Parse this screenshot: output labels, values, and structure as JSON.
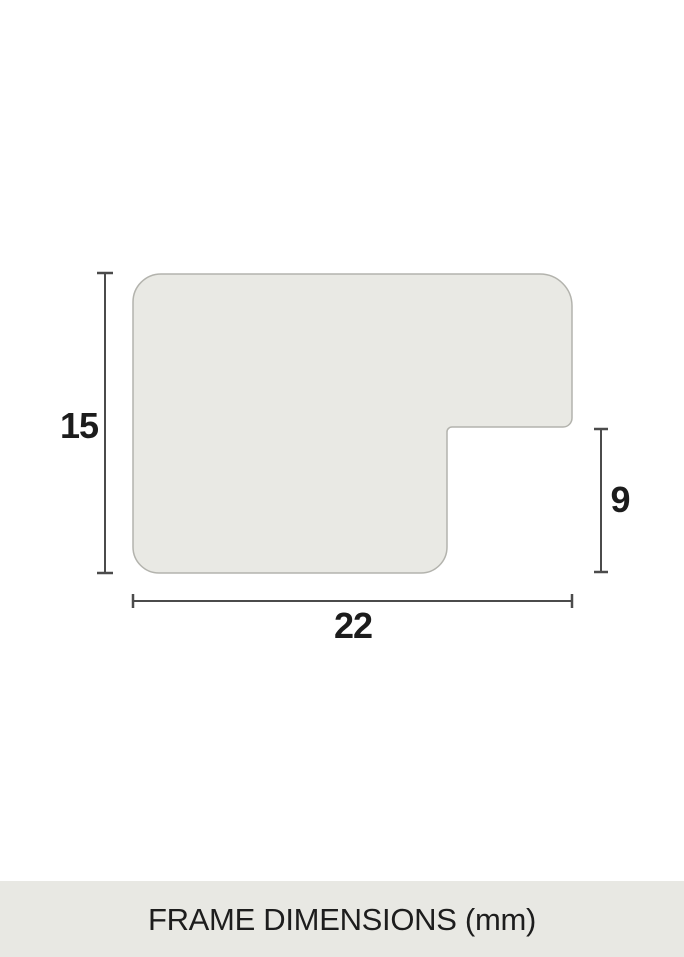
{
  "page": {
    "background_color": "#ffffff"
  },
  "diagram": {
    "type": "frame-profile-cross-section",
    "caption": "FRAME DIMENSIONS (mm)",
    "unit": "mm",
    "dimensions": {
      "height_label": "15",
      "rabbet_label": "9",
      "width_label": "22",
      "height_mm": 15,
      "rabbet_mm": 9,
      "width_mm": 22
    },
    "colors": {
      "profile_fill": "#e9e9e4",
      "profile_border": "#b3b3ad",
      "dimension_line": "#4b4b4b",
      "label_text": "#1c1c1c",
      "caption_background": "#e8e8e3",
      "caption_text": "#1d1d1d"
    }
  }
}
